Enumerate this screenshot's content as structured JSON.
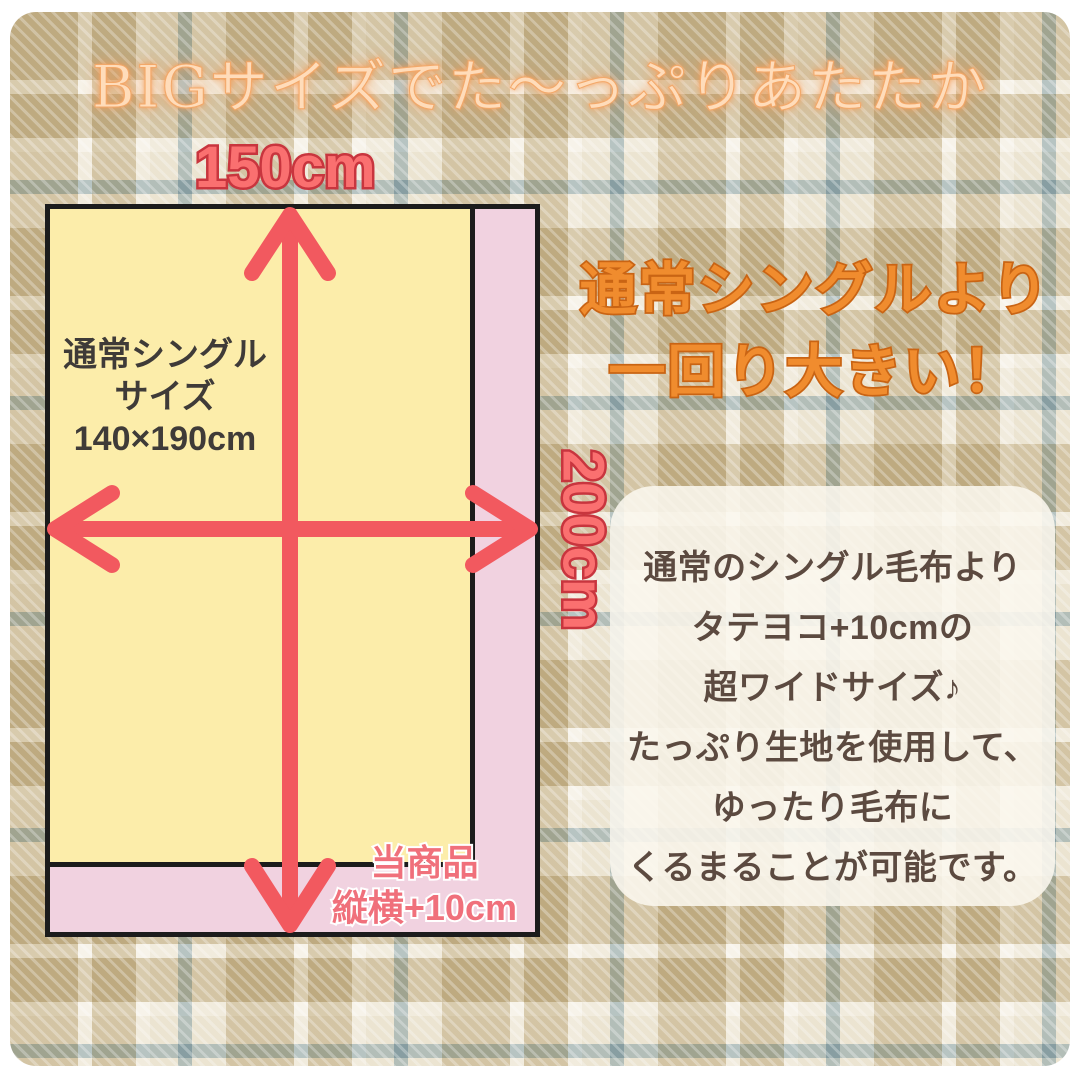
{
  "title": "BIGサイズでた〜っぷりあたたか",
  "diagram": {
    "width_label": "150cm",
    "height_label": "200cm",
    "single": {
      "line1": "通常シングル",
      "line2": "サイズ",
      "line3": "140×190cm"
    },
    "product": {
      "line1": "当商品",
      "line2": "縦横+10cm"
    }
  },
  "headline": {
    "line1": "通常シングルより",
    "line2": "一回り大きい！"
  },
  "description": {
    "lines": [
      "通常のシングル毛布より",
      "タテヨコ+10cmの",
      "超ワイドサイズ♪",
      "たっぷり生地を使用して、",
      "ゆったり毛布に",
      "くるまることが可能です。"
    ]
  },
  "colors": {
    "arrow_red": "#f2595f",
    "measure_label_fill": "#fa7070",
    "measure_label_stroke": "#c8353e",
    "single_yellow": "#fcedaa",
    "product_pink": "#f1d2e0",
    "headline_orange": "#f08c2e",
    "headline_orange_stroke": "#c96414",
    "title_peach": "#ffdcba",
    "title_glow": "#f69e5a",
    "description_text": "#5c4a40",
    "plaid_tan": "#d3c8ad",
    "plaid_cream": "#eae3d3",
    "plaid_blue": "#a8babc"
  }
}
